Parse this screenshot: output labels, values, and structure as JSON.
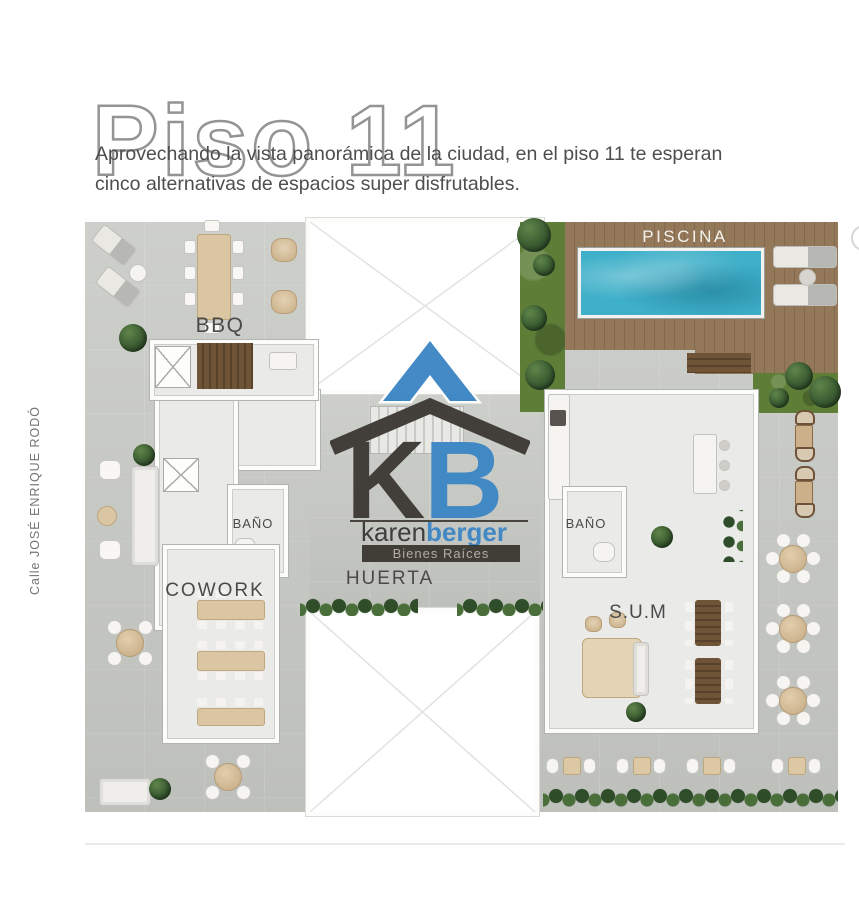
{
  "page": {
    "title": "Piso 11",
    "subtitle_line1": "Aprovechando la vista panorámica de la ciudad, en el piso 11 te esperan",
    "subtitle_line2": "cinco alternativas de espacios super disfrutables.",
    "street_label": "Calle JOSÉ ENRIQUE RODÓ"
  },
  "plan_labels": {
    "piscina": "PISCINA",
    "bbq": "BBQ",
    "bano_left": "BAÑO",
    "bano_right": "BAÑO",
    "cowork": "COWORK",
    "huerta": "HUERTA",
    "sum": "S.U.M"
  },
  "logo": {
    "letter_k": "K",
    "letter_b": "B",
    "name_part1": "karen",
    "name_part2": "berger",
    "tagline": "Bienes Raíces"
  },
  "colors": {
    "accent_blue": "#3d87c5",
    "logo_dark": "#3e3a36",
    "pool_water": "#3fb0c9",
    "deck_wood": "#8d7354",
    "terrace_gray": "#c8cac5",
    "grass_green": "#5e7e38",
    "title_outline": "#949494"
  }
}
